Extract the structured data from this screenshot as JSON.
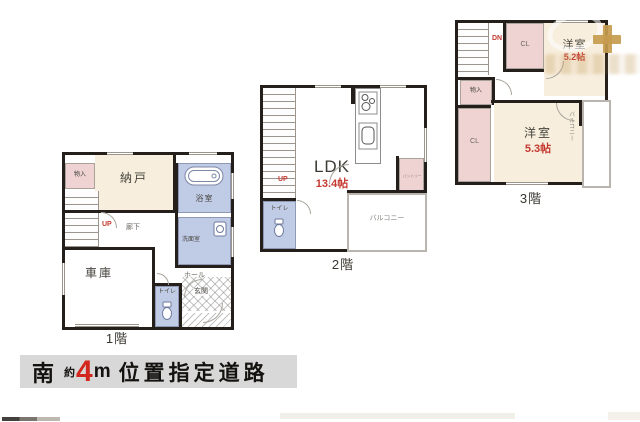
{
  "floor1": {
    "label": "1階",
    "nando": "納戸",
    "monoire": "物入",
    "yokushitsu": "浴室",
    "up": "UP",
    "rouka": "廊下",
    "senmenshitsu": "洗面室",
    "shako": "車庫",
    "hall": "ホール",
    "toire": "トイレ",
    "genkan": "玄関"
  },
  "floor2": {
    "label": "2階",
    "up": "UP",
    "toire": "トイレ",
    "ldk": "LDK",
    "ldk_size": "13.4帖",
    "pantry": "パントリー",
    "balcony": "バルコニー"
  },
  "floor3": {
    "label": "3階",
    "dn": "DN",
    "cl_top": "CL",
    "yoshitsu_top": "洋室",
    "yoshitsu_top_size": "5.2帖",
    "monoire": "物入",
    "cl_left": "CL",
    "yoshitsu_main": "洋室",
    "yoshitsu_main_size": "5.3帖",
    "balcony": "バルコニー"
  },
  "banner": {
    "south": "南",
    "approx": "約",
    "width_value": "4",
    "width_unit": "m",
    "road_text": "位置指定道路"
  },
  "colors": {
    "wall": "#241f1a",
    "room_cream": "#f7eedd",
    "closet_pink": "#eed3d2",
    "wet_area_blue": "#c0cbe6",
    "accent_red": "#c43a31",
    "banner_bg": "#d8d8d8",
    "banner_number_red": "#d3261c",
    "watermark_tan": "#c59b4e"
  }
}
